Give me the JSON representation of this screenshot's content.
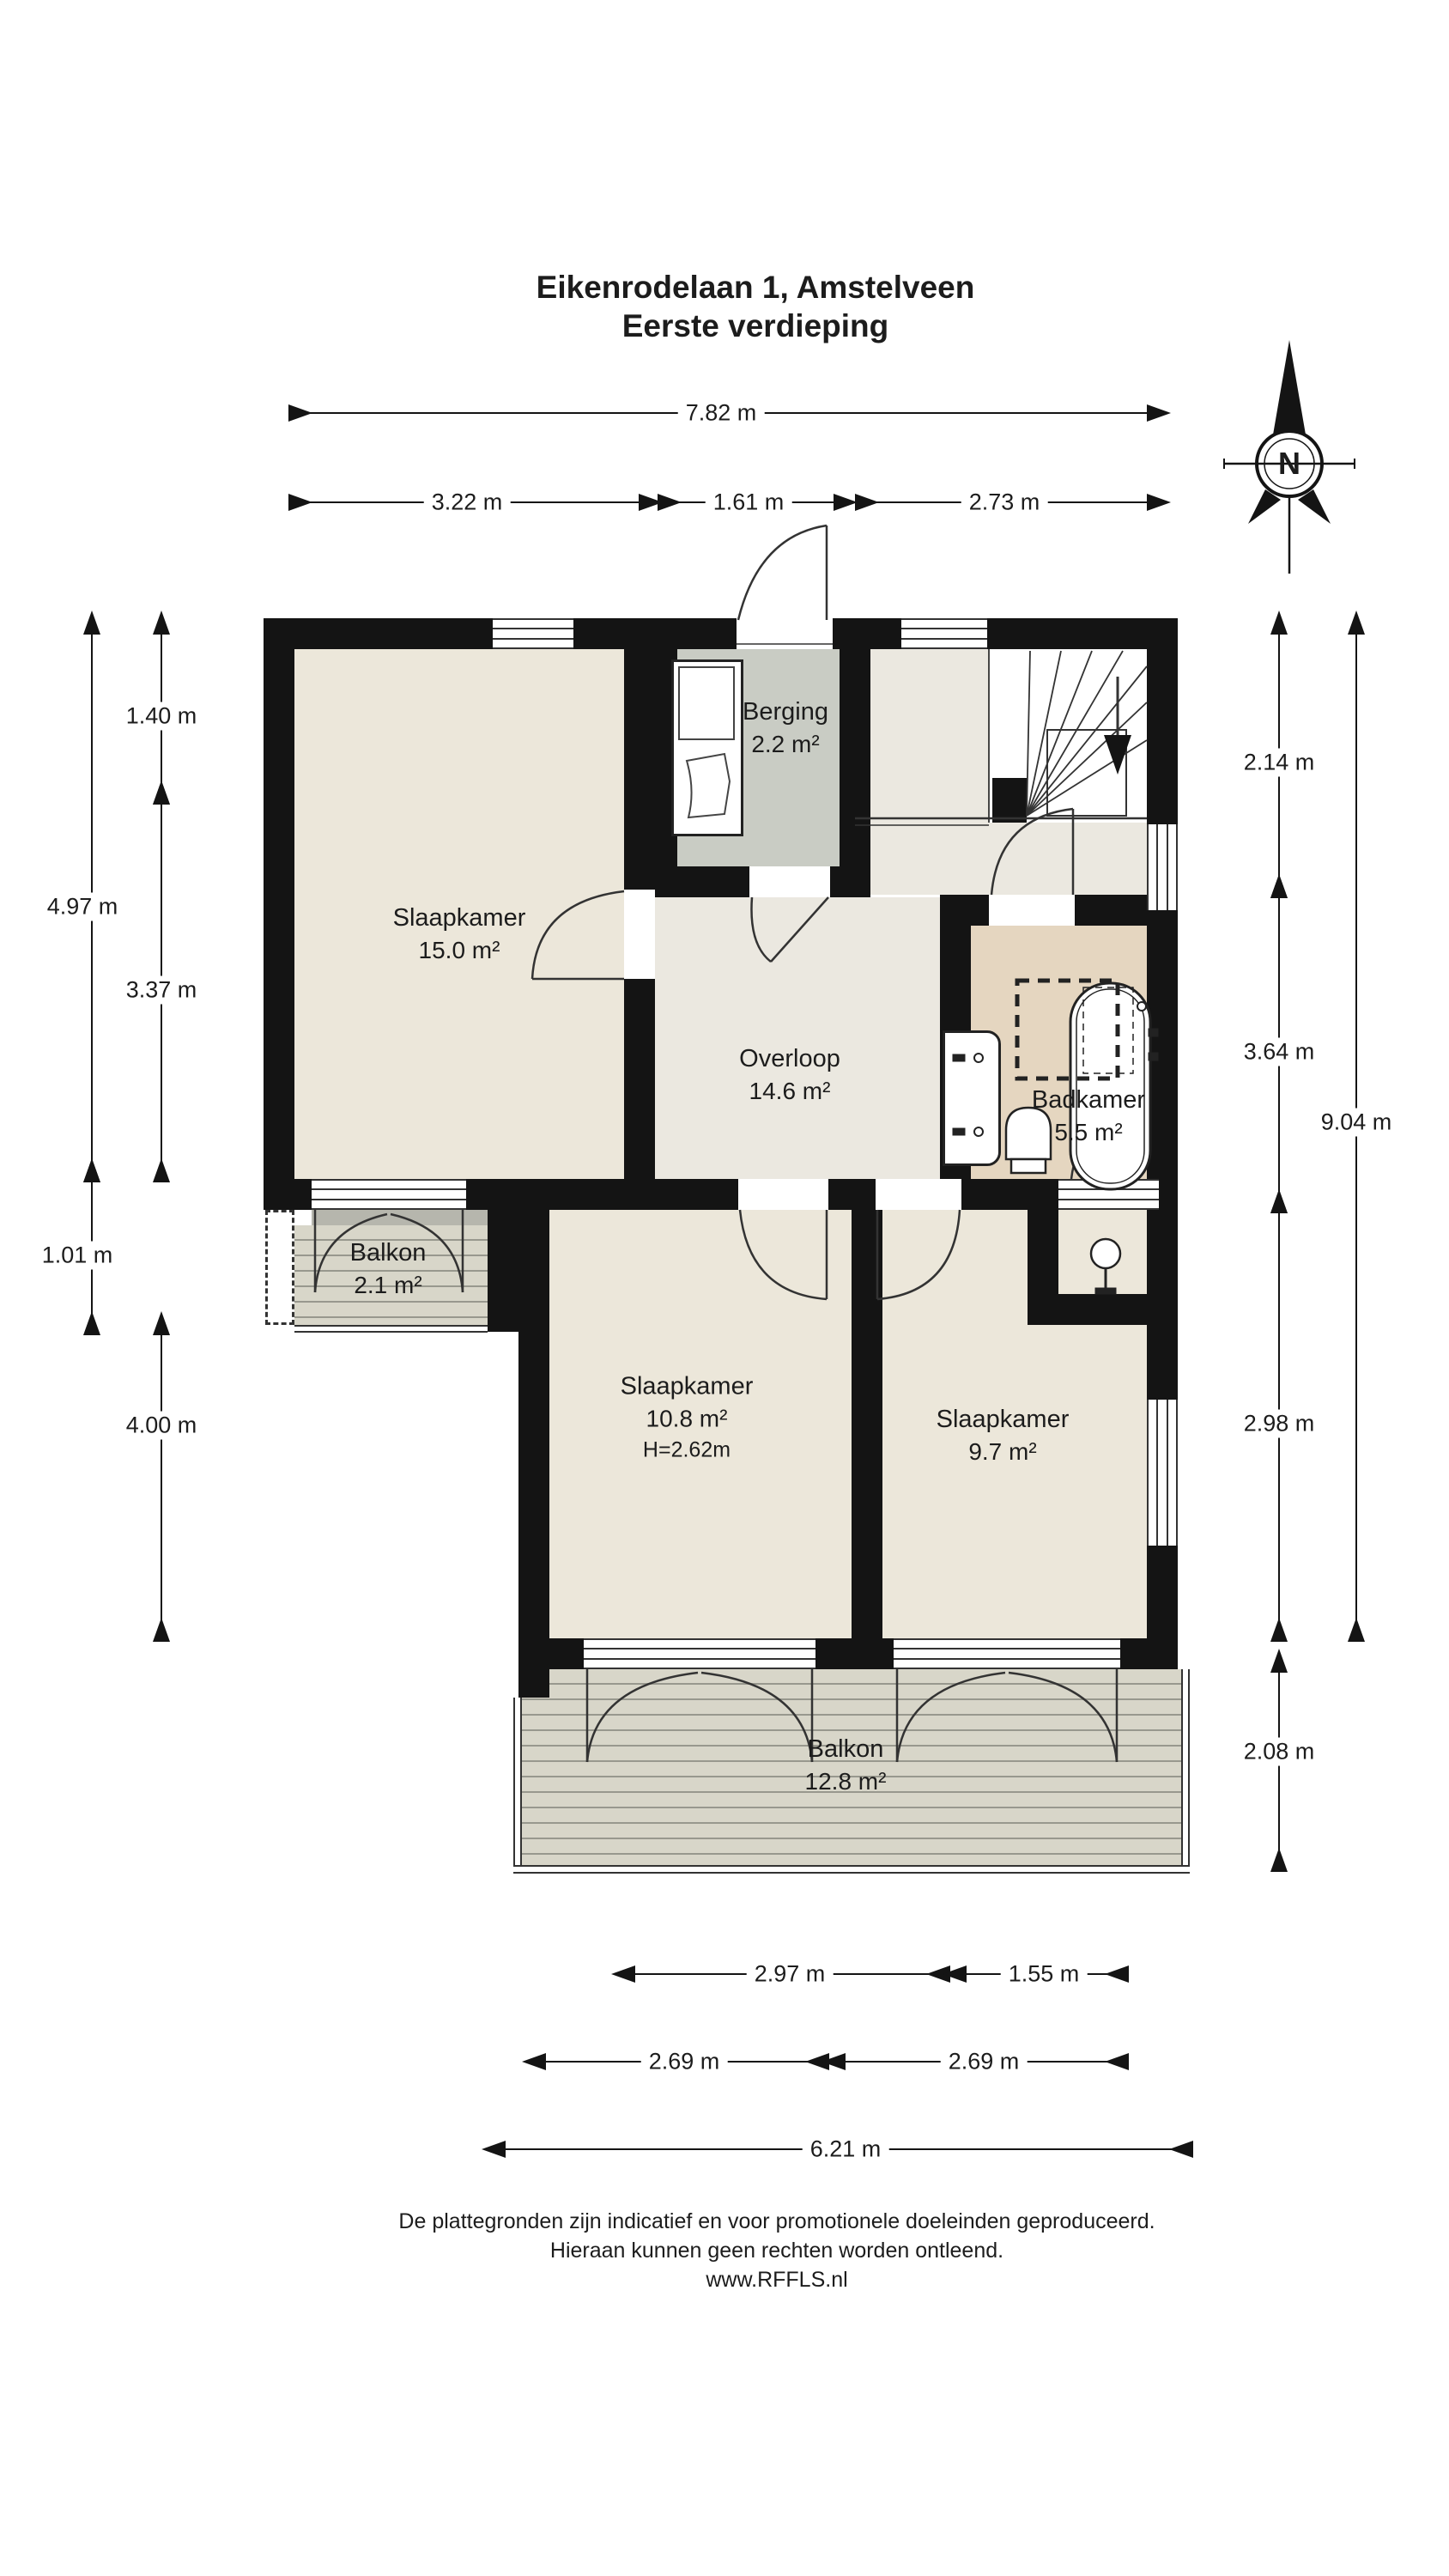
{
  "title": {
    "line1": "Eikenrodelaan 1, Amstelveen",
    "line2": "Eerste verdieping"
  },
  "compass": {
    "label": "N"
  },
  "rooms": {
    "slaapkamer15": {
      "name": "Slaapkamer",
      "area": "15.0 m²"
    },
    "berging": {
      "name": "Berging",
      "area": "2.2 m²"
    },
    "overloop": {
      "name": "Overloop",
      "area": "14.6 m²"
    },
    "badkamer": {
      "name": "Badkamer",
      "area": "5.5 m²"
    },
    "balkon_klein": {
      "name": "Balkon",
      "area": "2.1 m²"
    },
    "slaapkamer108": {
      "name": "Slaapkamer",
      "area": "10.8 m²",
      "height": "H=2.62m"
    },
    "slaapkamer97": {
      "name": "Slaapkamer",
      "area": "9.7 m²"
    },
    "balkon_groot": {
      "name": "Balkon",
      "area": "12.8 m²"
    }
  },
  "dimensions": {
    "top": [
      "7.82 m",
      "3.22 m",
      "1.61 m",
      "2.73 m"
    ],
    "left": [
      "4.97 m",
      "1.40 m",
      "3.37 m",
      "1.01 m",
      "4.00 m"
    ],
    "right": [
      "2.14 m",
      "3.64 m",
      "2.98 m",
      "2.08 m",
      "9.04 m"
    ],
    "bottom": [
      "2.97 m",
      "1.55 m",
      "2.69 m",
      "2.69 m",
      "6.21 m"
    ]
  },
  "footer": {
    "line1": "De plattegronden zijn indicatief en voor promotionele doeleinden geproduceerd.",
    "line2": "Hieraan kunnen geen rechten worden ontleend.",
    "line3": "www.RFFLS.nl"
  }
}
